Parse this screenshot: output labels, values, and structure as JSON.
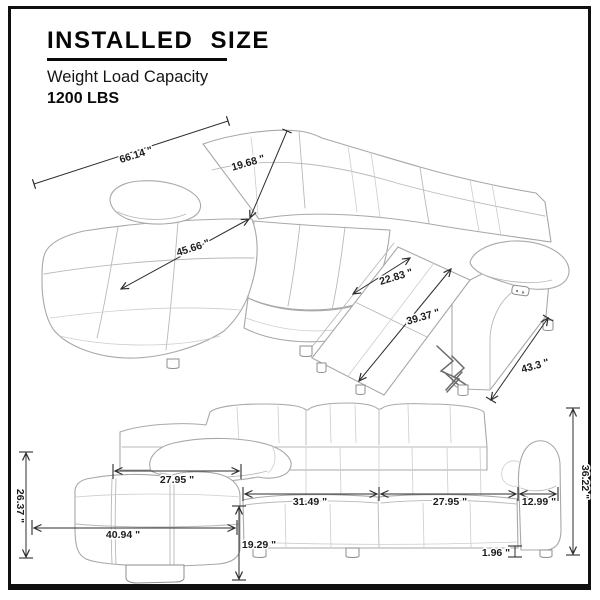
{
  "header": {
    "title": "INSTALLED SIZE",
    "subtitle": "Weight Load Capacity",
    "capacity": "1200 LBS"
  },
  "colors": {
    "frame": "#101010",
    "dimension_lines": "#2d2d2d",
    "sketch_lines": "#a8a8a8",
    "text": "#1c1c1c",
    "background": "#ffffff"
  },
  "top_view": {
    "description": "isometric sectional sofa with chaise and extended recliner",
    "dims": {
      "total_width": "66.14 \"",
      "back_height": "19.68 \"",
      "chaise_length": "45.66 \"",
      "recliner_seat_width": "22.83 \"",
      "recline_extension": "39.37 \"",
      "depth": "43.3 \""
    }
  },
  "front_view": {
    "description": "front elevation of sectional sofa",
    "dims": {
      "chaise_back_height": "26.37 \"",
      "chaise_seat_width": "27.95 \"",
      "chaise_total_width": "40.94 \"",
      "seat_height": "19.29 \"",
      "left_seat_width": "31.49 \"",
      "right_seat_width": "27.95 \"",
      "armrest_width": "12.99 \"",
      "total_height": "36.22 \"",
      "leg_height": "1.96 \""
    }
  }
}
